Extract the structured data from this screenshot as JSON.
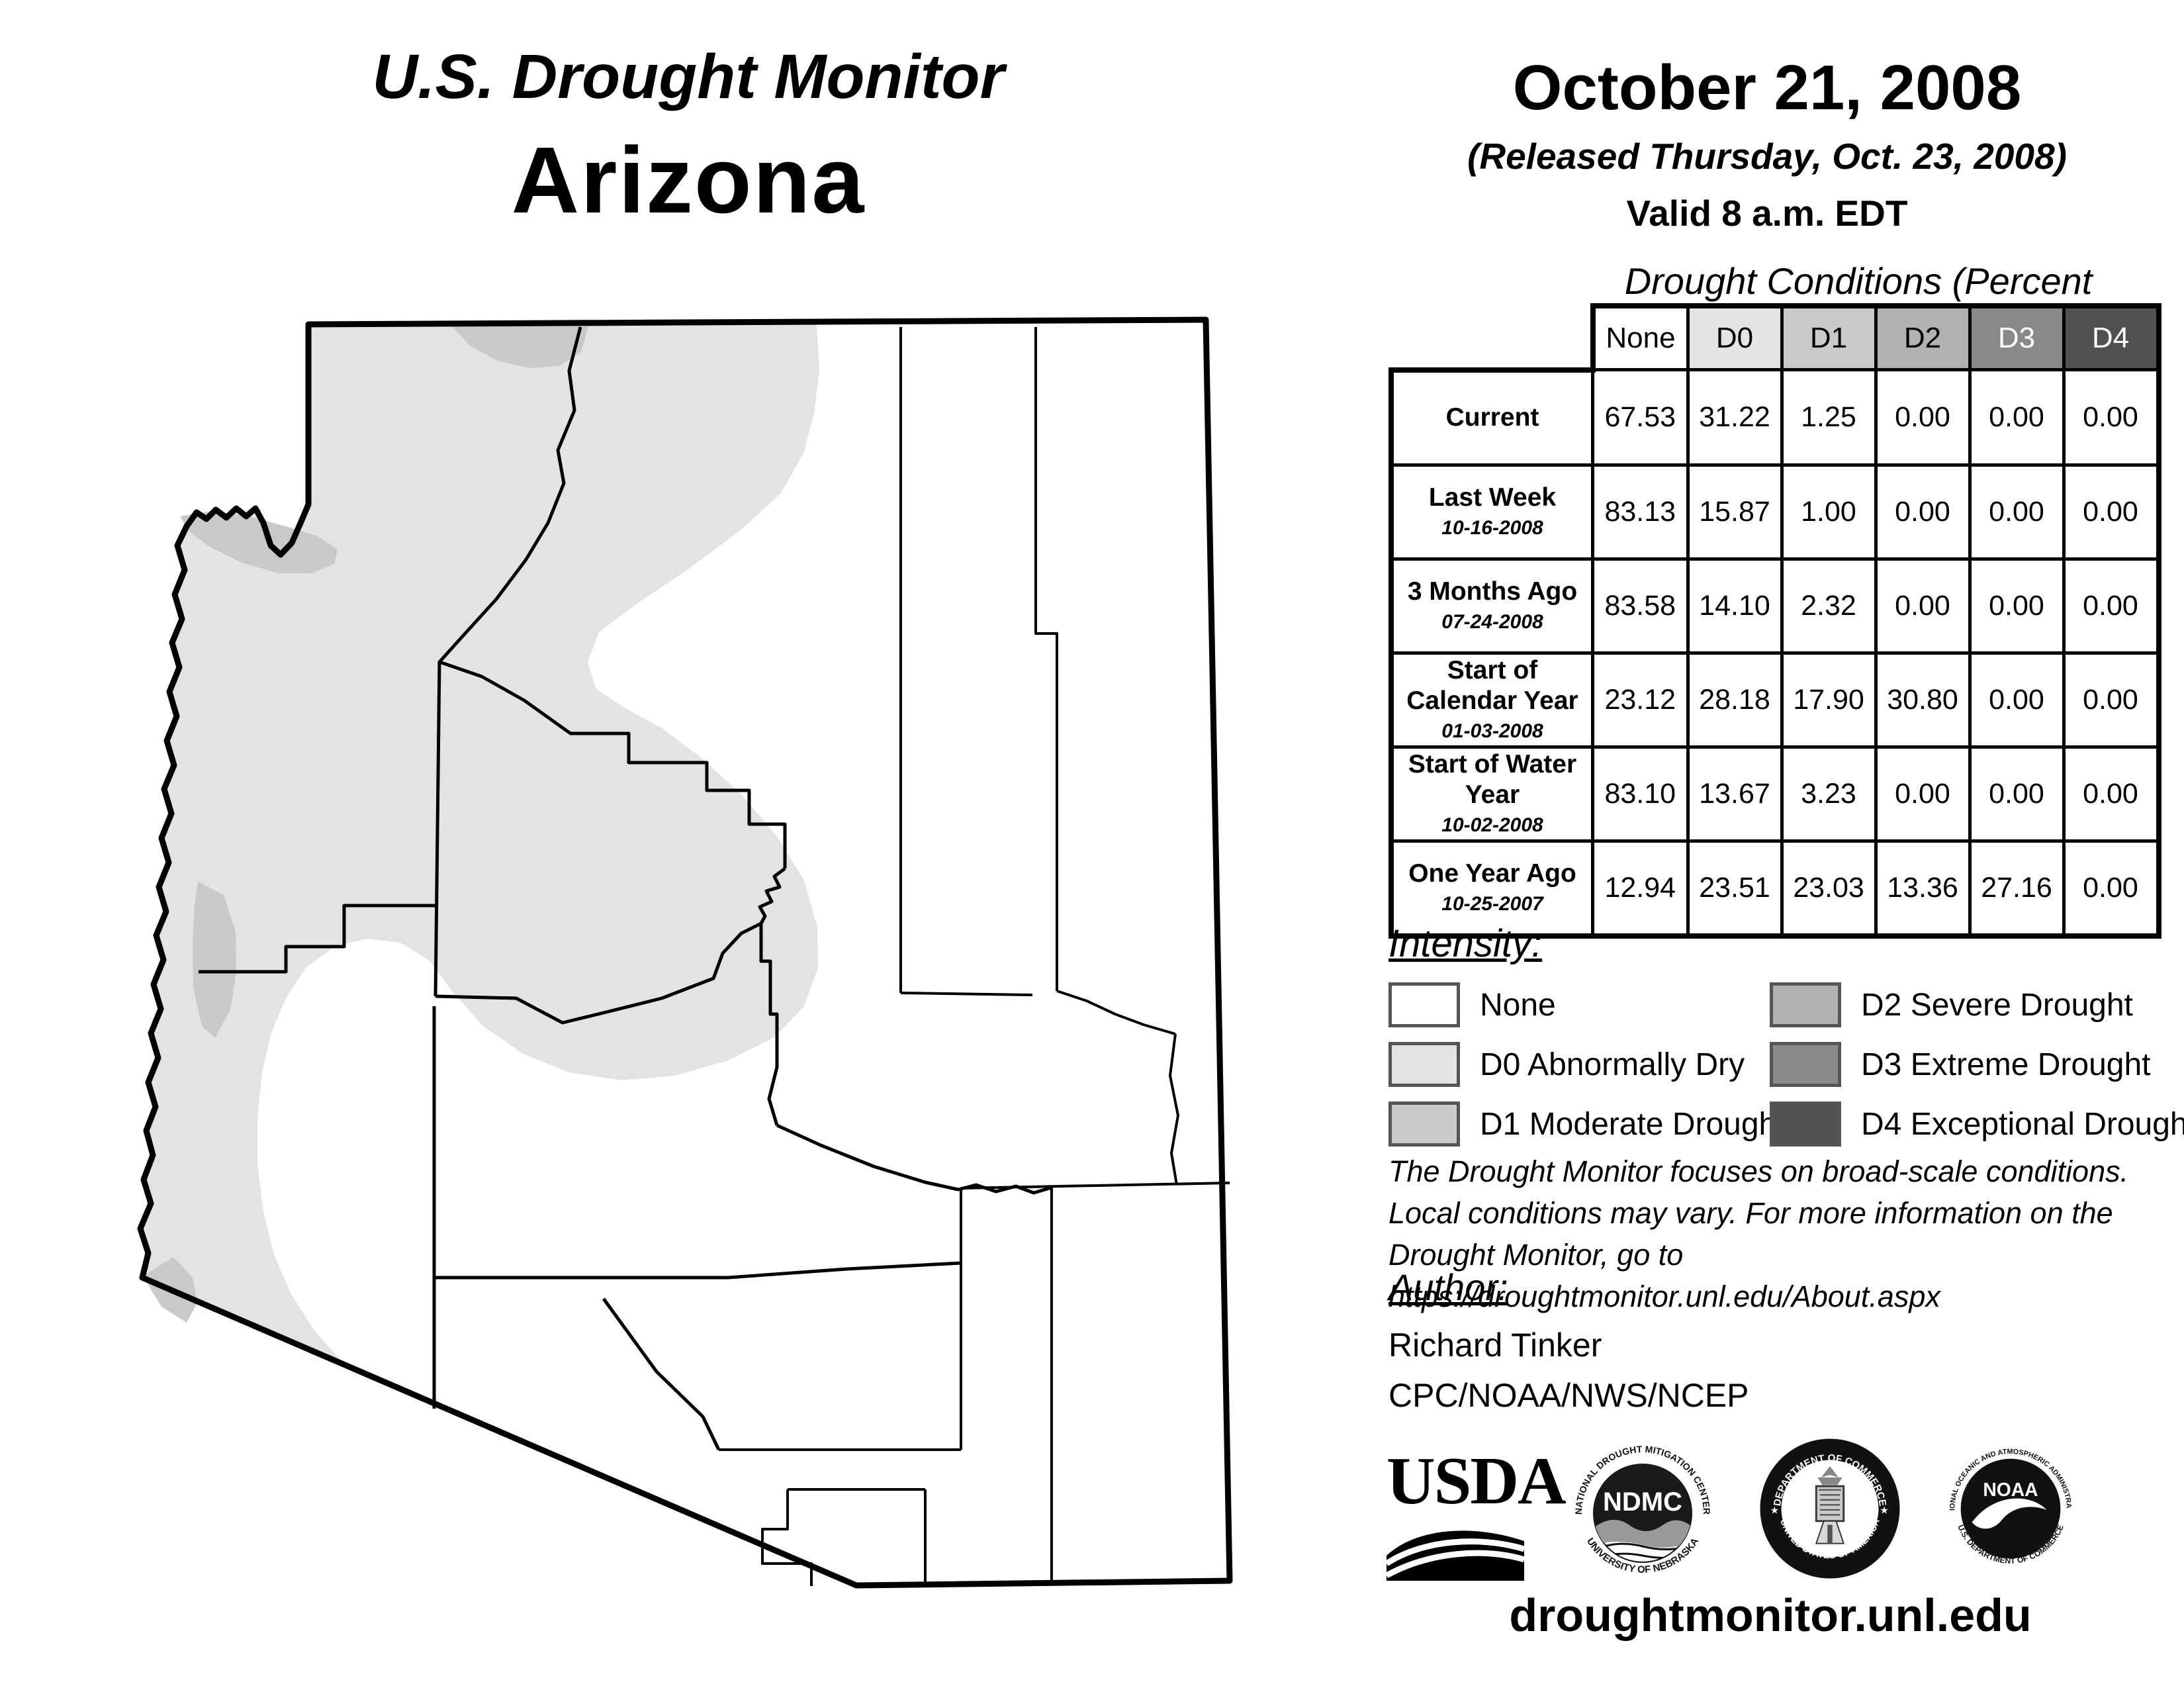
{
  "title": {
    "line1": "U.S. Drought Monitor",
    "line2": "Arizona"
  },
  "date_block": {
    "date": "October 21, 2008",
    "released": "(Released Thursday, Oct. 23, 2008)",
    "valid": "Valid 8 a.m. EDT"
  },
  "table": {
    "caption": "Drought Conditions (Percent Area)",
    "columns": [
      "None",
      "D0",
      "D1",
      "D2",
      "D3",
      "D4"
    ],
    "rows": [
      {
        "label": "Current",
        "date": "",
        "values": [
          "67.53",
          "31.22",
          "1.25",
          "0.00",
          "0.00",
          "0.00"
        ]
      },
      {
        "label": "Last Week",
        "date": "10-16-2008",
        "values": [
          "83.13",
          "15.87",
          "1.00",
          "0.00",
          "0.00",
          "0.00"
        ]
      },
      {
        "label": "3 Months Ago",
        "date": "07-24-2008",
        "values": [
          "83.58",
          "14.10",
          "2.32",
          "0.00",
          "0.00",
          "0.00"
        ]
      },
      {
        "label": "Start of Calendar Year",
        "date": "01-03-2008",
        "values": [
          "23.12",
          "28.18",
          "17.90",
          "30.80",
          "0.00",
          "0.00"
        ]
      },
      {
        "label": "Start of Water Year",
        "date": "10-02-2008",
        "values": [
          "83.10",
          "13.67",
          "3.23",
          "0.00",
          "0.00",
          "0.00"
        ]
      },
      {
        "label": "One Year Ago",
        "date": "10-25-2007",
        "values": [
          "12.94",
          "23.51",
          "23.03",
          "13.36",
          "27.16",
          "0.00"
        ]
      }
    ]
  },
  "legend": {
    "heading": "Intensity:",
    "items": [
      {
        "code": "none",
        "label": "None"
      },
      {
        "code": "d0",
        "label": "D0 Abnormally Dry"
      },
      {
        "code": "d1",
        "label": "D1 Moderate Drought"
      },
      {
        "code": "d2",
        "label": "D2 Severe Drought"
      },
      {
        "code": "d3",
        "label": "D3 Extreme Drought"
      },
      {
        "code": "d4",
        "label": "D4 Exceptional Drought"
      }
    ]
  },
  "colors": {
    "none": "#ffffff",
    "d0": "#e3e3e3",
    "d1": "#c9c9c9",
    "d2": "#b1b1b1",
    "d3": "#898989",
    "d4": "#515151",
    "swatch_border": "#555555"
  },
  "disclaimer": {
    "line1": "The Drought Monitor focuses on broad-scale conditions.",
    "line2": "Local conditions may vary. For more information on the",
    "line3": "Drought Monitor, go to https://droughtmonitor.unl.edu/About.aspx"
  },
  "author": {
    "heading": "Author:",
    "name": "Richard Tinker",
    "org": "CPC/NOAA/NWS/NCEP"
  },
  "logos": {
    "usda": "USDA",
    "ndmc_top": "NATIONAL DROUGHT MITIGATION CENTER",
    "ndmc_center": "NDMC",
    "ndmc_bottom": "UNIVERSITY OF NEBRASKA",
    "doc_top": "DEPARTMENT OF COMMERCE",
    "doc_bottom": "UNITED STATES OF AMERICA",
    "noaa_top": "NATIONAL OCEANIC AND ATMOSPHERIC ADMINISTRATION",
    "noaa_center": "NOAA",
    "noaa_bottom": "U.S. DEPARTMENT OF COMMERCE"
  },
  "website": "droughtmonitor.unl.edu"
}
